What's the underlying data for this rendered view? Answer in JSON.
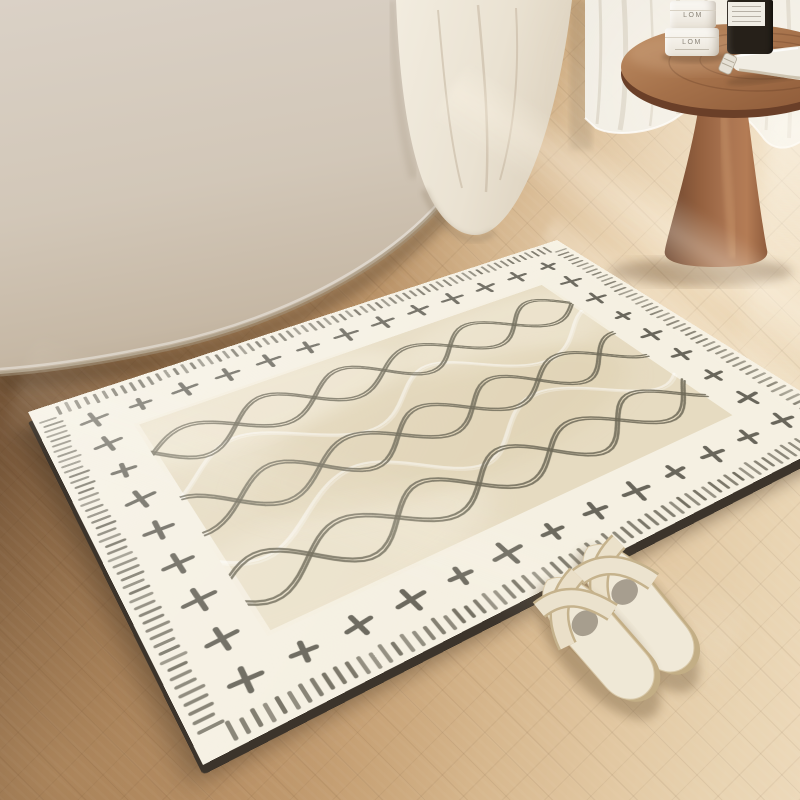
{
  "image_type": "product-photo",
  "scene_description": "Cream boho bath mat with cross-and-wave pattern lying on a herringbone wood floor beside a beige bathtub with a draped towel, a sheer curtain, a round wooden pedestal side table holding skincare items, and a pair of cream slide slippers",
  "items": {
    "jar_top": {
      "label": "LOM"
    },
    "jar_bottom": {
      "label": "LOM"
    }
  },
  "palette": {
    "floor_dark": "#63482f",
    "floor_light": "#edd9ba",
    "tub": "#d6ccc0",
    "towel": "#efe9dc",
    "curtain": "#f3f0e9",
    "wood_top": "#a9714c",
    "wood_dark": "#6a3f28",
    "rug_ground": "#f5f0e2",
    "rug_field": "#e6dbc1",
    "fringe": "#6b6759",
    "cross": "#565349",
    "wave_dark": "#6d6857",
    "wave_white": "#ffffff",
    "slipper": "#ece2cc",
    "rug_edge": "#3c342b"
  },
  "rug": {
    "fringe": {
      "count_h": 66,
      "count_v": 48,
      "len": 13
    },
    "crosses": {
      "cols": 13,
      "rows": 7,
      "size": 10
    },
    "waves": {
      "dark_rows": [
        128,
        226,
        320
      ],
      "dark_phases": [
        0.2,
        1.8,
        0.9
      ],
      "white_rows": [
        177,
        272
      ],
      "white_phases": [
        2.6,
        0.7
      ],
      "amplitude": 26,
      "wavelength": 150
    }
  }
}
